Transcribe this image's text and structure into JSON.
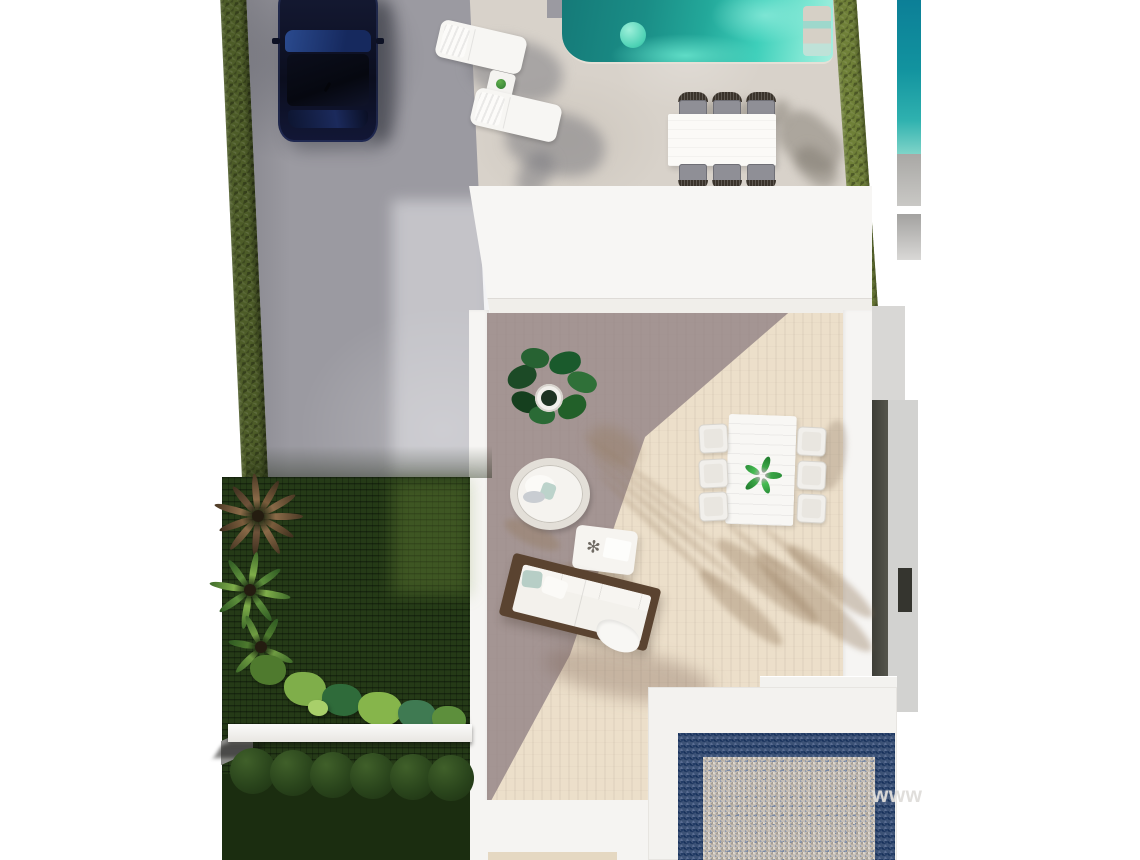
{
  "image": {
    "kind": "aerial-3d-architectural-render",
    "subject": "Top-down render of a modern villa plot: hex-paved driveway with parked navy car, turquoise swimming pool with float and steps, two sun loungers with side table, poolside dining table with six grey chairs, white flat roof, sunken terrace with potted fig plant, hanging rattan chair, coffee table, wooden outdoor sofa and white dining set for six, dark garden lawn with palms, shrubs, planter ledge and trimmed hedge balls, blue-bordered gravel patio, neighbouring pool strips on both sides",
    "watermark_text": "www"
  },
  "counts": {
    "sun_loungers": 2,
    "poolside_chairs": 6,
    "terrace_chairs": 6,
    "hedge_balls": 6
  },
  "palette": {
    "background": "#ffffff",
    "driveway_gray": "#9b9aa1",
    "pool_deck": "#d8d2ca",
    "pool_teal_dark": "#157a78",
    "pool_teal_light": "#7ce6d2",
    "pool_float_mint": "#4cd1b4",
    "car_navy": "#10142a",
    "hedge_olive": "#4d5c28",
    "hedge_bright": "#6f8038",
    "lawn_dark_green": "#253a17",
    "palm_brown": "#8a6a48",
    "palm_green": "#6f9c42",
    "roof_white": "#f7f6f4",
    "terrace_shade": "#b5aaa8",
    "terrace_sun": "#ecdfca",
    "sofa_wood": "#5a4330",
    "pillow_blue": "#b7cec6",
    "gravel_border_navy": "#3c5276",
    "gravel_fill": "#c6bfb7",
    "neighbor_pool_teal": "#12939f",
    "wall_dark": "#3e3e37",
    "watermark_gray": "#dedcd9"
  },
  "objects": [
    "driveway",
    "parked-car",
    "left-hedge",
    "swimming-pool",
    "pool-steps",
    "pool-float",
    "sun-loungers",
    "lounger-side-table",
    "poolside-dining-table",
    "poolside-chairs",
    "right-hedge",
    "neighbor-pool",
    "house-roof",
    "terrace-floor",
    "potted-fig-plant",
    "hanging-chair",
    "coffee-table",
    "outdoor-sofa",
    "terrace-dining-table",
    "terrace-dining-chairs",
    "garden-lawn",
    "brown-palm",
    "green-palms",
    "shrub-row",
    "planter-ledge",
    "hedge-balls",
    "gravel-patio",
    "neighbor-wall-window",
    "watermark"
  ]
}
